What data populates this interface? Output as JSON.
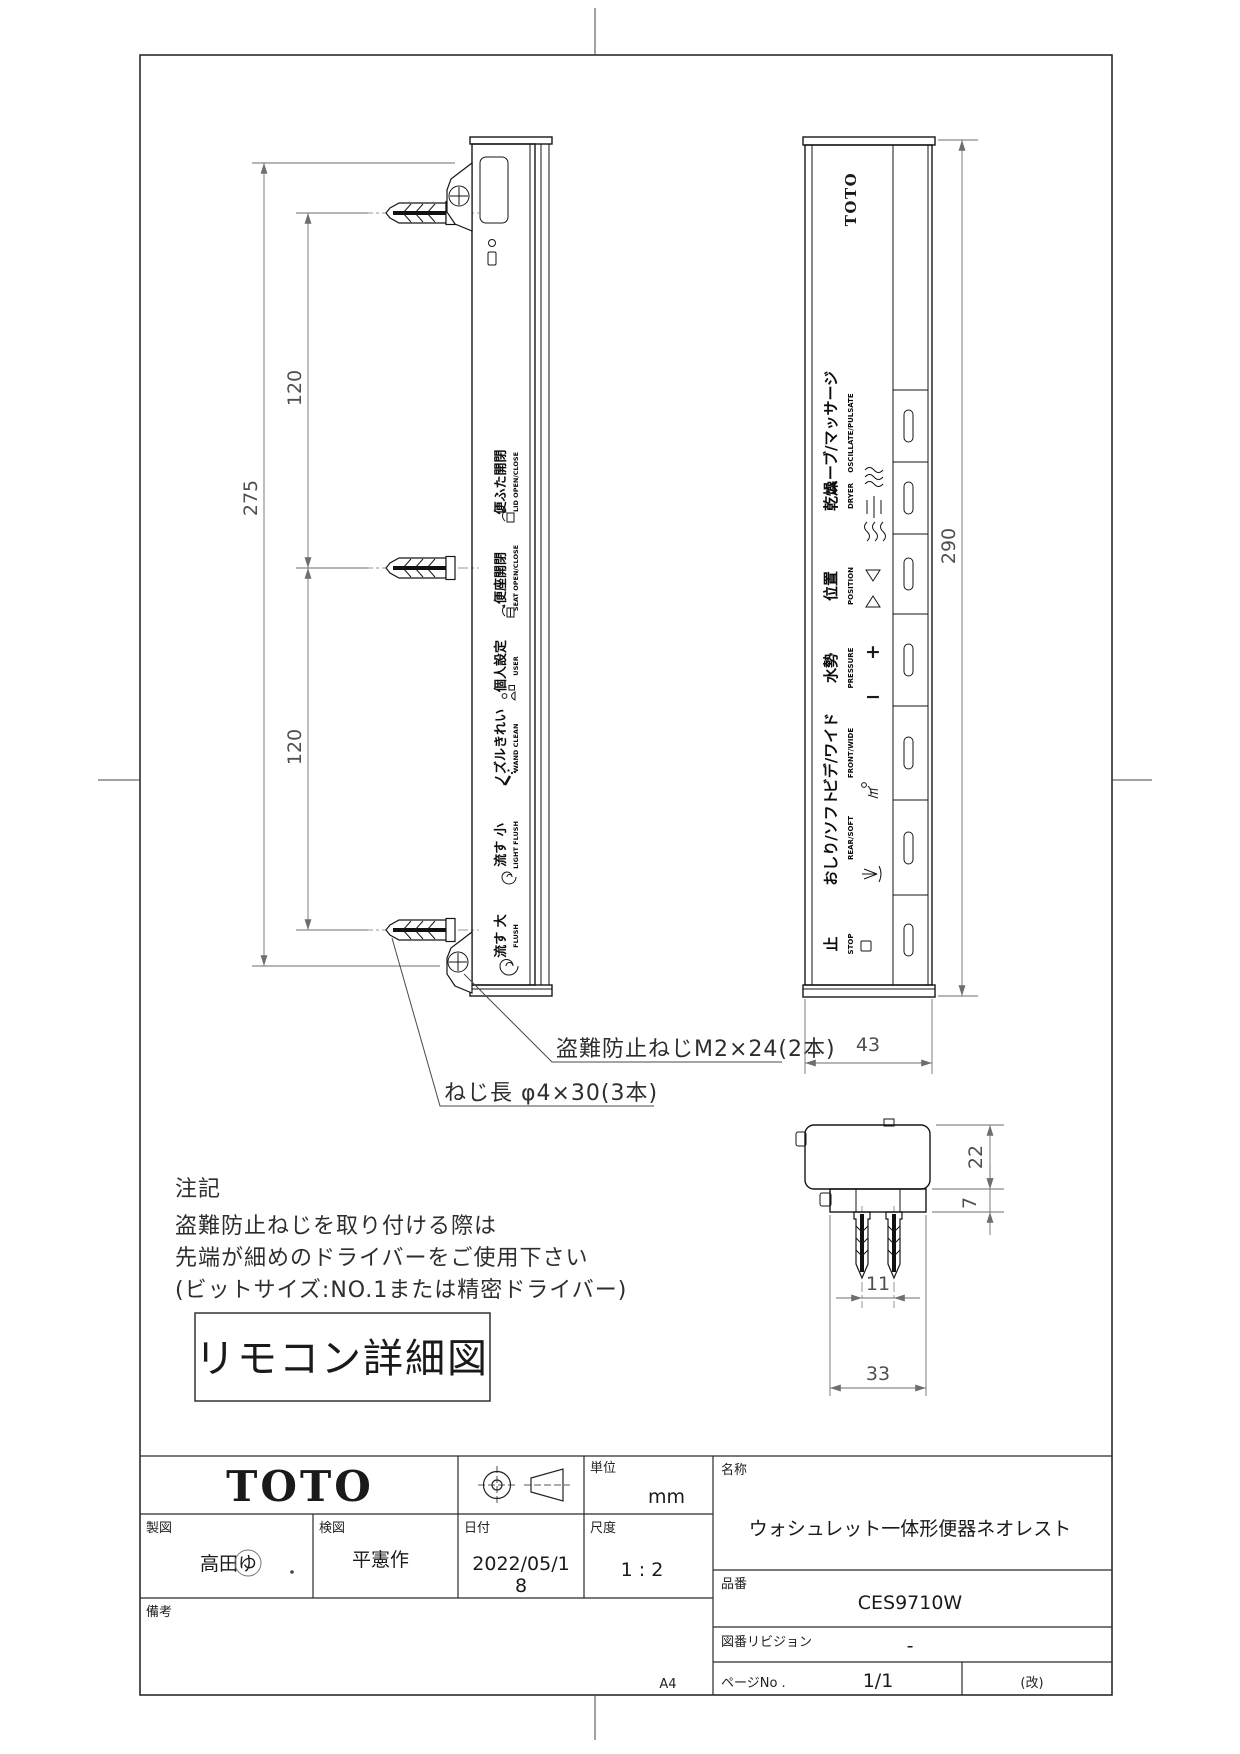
{
  "drawing": {
    "detail_label": "リモコン詳細図",
    "paper_size": "A4",
    "notes": {
      "title": "注記",
      "line1": "盗難防止ねじを取り付ける際は",
      "line2": "先端が細めのドライバーをご使用下さい",
      "line3": "(ビットサイズ:NO.1または精密ドライバー)"
    },
    "callouts": {
      "anti_theft_screw": "盗難防止ねじM2×24(2本)",
      "screw_length": "ねじ長 φ4×30(3本)"
    },
    "side_view": {
      "dims": {
        "total": "275",
        "upper": "120",
        "lower": "120"
      },
      "labels": [
        {
          "jp": "便ふた開閉",
          "en": "LID OPEN/CLOSE"
        },
        {
          "jp": "便座開閉",
          "en": "SEAT OPEN/CLOSE"
        },
        {
          "jp": "個人設定",
          "en": "USER"
        },
        {
          "jp": "ノズルきれい",
          "en": "WAND CLEAN"
        },
        {
          "jp": "流す 小",
          "en": "LIGHT FLUSH"
        },
        {
          "jp": "流す 大",
          "en": "FLUSH"
        }
      ]
    },
    "front_view": {
      "brand": "TOTO",
      "dims": {
        "height": "290",
        "width": "43"
      },
      "rows": [
        {
          "jp": "ムーブ/マッサージ",
          "en": "OSCILLATE/PULSATE"
        },
        {
          "jp": "乾燥",
          "en": "DRYER"
        },
        {
          "jp": "位置",
          "en": "POSITION"
        },
        {
          "jp": "水勢",
          "en": "PRESSURE"
        },
        {
          "jp": "ビデ/ワイド",
          "en": "FRONT/WIDE"
        },
        {
          "jp": "おしり/ソフト",
          "en": "REAR/SOFT"
        },
        {
          "jp": "止",
          "en": "STOP"
        }
      ],
      "glyphs": {
        "plus": "+",
        "minus": "−"
      }
    },
    "top_view": {
      "dims": {
        "body": "22",
        "plate": "7",
        "pitch": "11",
        "width": "33"
      }
    }
  },
  "title_block": {
    "brand": "TOTO",
    "unit": {
      "label": "単位",
      "value": "mm"
    },
    "drafter": {
      "label": "製図",
      "value": "高田ゆ"
    },
    "checker": {
      "label": "検図",
      "value": "平憲作"
    },
    "date": {
      "label": "日付",
      "value_line1": "2022/05/1",
      "value_line2": "8"
    },
    "scale": {
      "label": "尺度",
      "value": "1 : 2"
    },
    "name": {
      "label": "名称",
      "value": "ウォシュレット一体形便器ネオレスト"
    },
    "part": {
      "label": "品番",
      "value": "CES9710W"
    },
    "revision": {
      "label": "図番リビジョン",
      "value": "-"
    },
    "remarks": {
      "label": "備考"
    },
    "page": {
      "label": "ページNo .",
      "value": "1/1",
      "rev": "(改)"
    }
  }
}
